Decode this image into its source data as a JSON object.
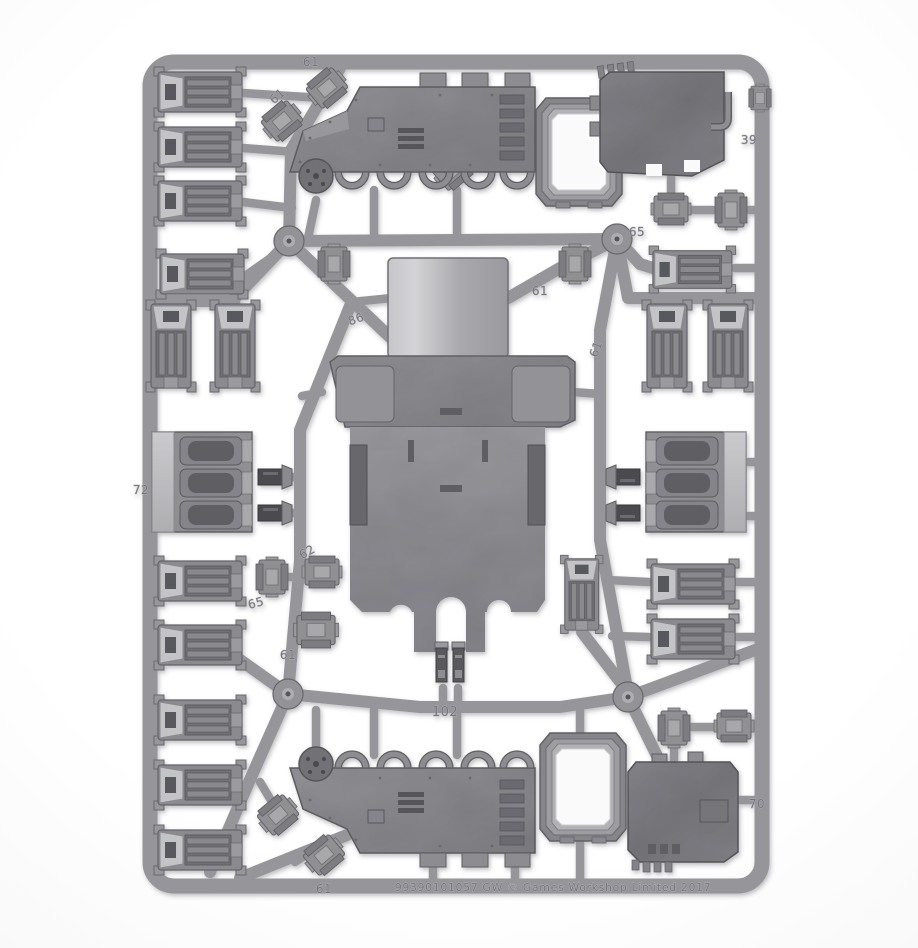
{
  "meta": {
    "description": "Photograph of a grey plastic model-kit sprue (vehicle frame with hull, side panels, ramps, hatches, exhaust blocks and track links) on a white background"
  },
  "palette": {
    "background": "#fafafb",
    "sprue": "#96969a",
    "sprue_outline": "#6b6b70",
    "part_light": "#c6c6c9",
    "part_mid": "#8e8e92",
    "part_dark": "#5e5e63",
    "recess": "#55555a",
    "opening_white": "#fafafb"
  },
  "markings": [
    {
      "label": "61",
      "location": "top-frame-center"
    },
    {
      "label": "61",
      "location": "top-left-diagonal-runner"
    },
    {
      "label": "39",
      "location": "right-frame-upper"
    },
    {
      "label": "86",
      "location": "left-of-hull-top"
    },
    {
      "label": "61",
      "location": "right-of-hull-top"
    },
    {
      "label": "61",
      "location": "right-inner-runner"
    },
    {
      "label": "65",
      "location": "right-junction"
    },
    {
      "label": "72",
      "location": "left-frame-middle"
    },
    {
      "label": "62",
      "location": "left-inner-runner"
    },
    {
      "label": "65",
      "location": "lower-left-runner"
    },
    {
      "label": "61",
      "location": "lower-left-vertical-runner"
    },
    {
      "label": "102",
      "location": "bottom-center-runner"
    },
    {
      "label": "61",
      "location": "bottom-frame-left"
    },
    {
      "label": "70",
      "location": "right-frame-lower"
    }
  ],
  "bottom_text": {
    "label": "99390101057   GW   © Games Workshop Limited 2017"
  },
  "parts_inventory": [
    {
      "name": "vehicle-hull",
      "count": 1
    },
    {
      "name": "side-panel-with-wheel-arches",
      "count": 2
    },
    {
      "name": "rear-ramp-door",
      "count": 2
    },
    {
      "name": "hatch-frame",
      "count": 2
    },
    {
      "name": "exhaust-vent-block",
      "count": 2
    },
    {
      "name": "track-link-section",
      "count": 17
    },
    {
      "name": "small-box-fitting",
      "count": 14
    },
    {
      "name": "twin-exhaust-stack",
      "count": 1
    },
    {
      "name": "drive-hub-disc",
      "count": 2
    },
    {
      "name": "frame-clip",
      "count": 1
    }
  ]
}
